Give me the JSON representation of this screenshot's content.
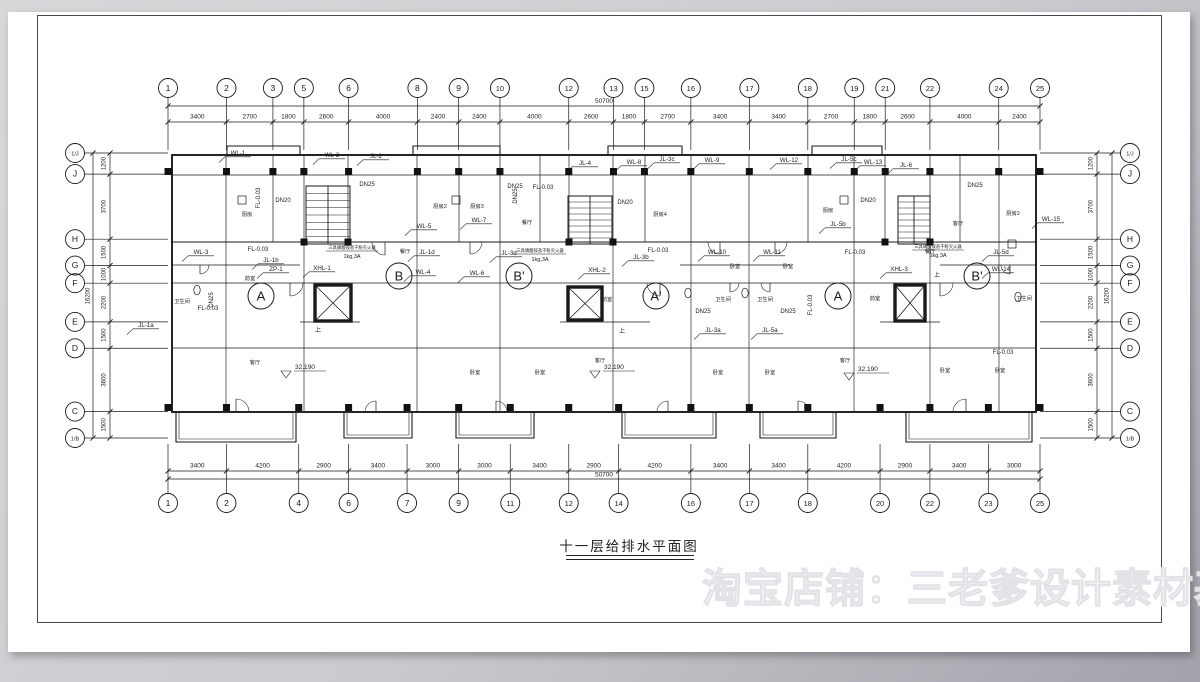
{
  "page": {
    "title": "十一层给排水平面图",
    "watermark": "淘宝店铺：三老爹设计素材基地"
  },
  "axes": {
    "top": {
      "bubbles": [
        "1",
        "2",
        "3",
        "5",
        "6",
        "8",
        "9",
        "10",
        "12",
        "13",
        "15",
        "16",
        "17",
        "18",
        "19",
        "21",
        "22",
        "24",
        "25"
      ],
      "dims": [
        3400,
        2700,
        1800,
        2600,
        4000,
        2400,
        2400,
        4000,
        2600,
        1800,
        2700,
        3400,
        3400,
        2700,
        1800,
        2600,
        4000,
        2400
      ],
      "total": "50700"
    },
    "bottom": {
      "bubbles": [
        "1",
        "2",
        "4",
        "6",
        "7",
        "9",
        "11",
        "12",
        "14",
        "16",
        "17",
        "18",
        "20",
        "22",
        "23",
        "25"
      ],
      "dims": [
        3400,
        4200,
        2900,
        3400,
        3000,
        3000,
        3400,
        2900,
        4200,
        3400,
        3400,
        4200,
        2900,
        3400,
        3000
      ],
      "total": "50700"
    },
    "left": {
      "bubbles": [
        "1/J",
        "J",
        "H",
        "G",
        "F",
        "E",
        "D",
        "C",
        "1/B"
      ],
      "dims": [
        1200,
        3700,
        1500,
        1000,
        2200,
        1500,
        3600,
        1500
      ],
      "total": "16200"
    },
    "right": {
      "bubbles": [
        "1/J",
        "J",
        "H",
        "G",
        "F",
        "E",
        "D",
        "C",
        "1/B"
      ],
      "dims": [
        1200,
        3700,
        1500,
        1000,
        2200,
        1500,
        3600,
        1500
      ],
      "total": "16200"
    }
  },
  "plan": {
    "unit_circles": [
      "A",
      "B",
      "B'",
      "A'",
      "A",
      "B'"
    ],
    "riser_labels": [
      "WL-1",
      "WL-2",
      "JL-2",
      "WL-3",
      "JL-1a",
      "JL-1b",
      "ZP-1",
      "XHL-1",
      "WL-5",
      "WL-7",
      "JL-1d",
      "JL-3d",
      "WL-4",
      "WL-6",
      "JL-4",
      "WL-8",
      "JL-3c",
      "WL-9",
      "JL-3b",
      "XHL-2",
      "WL-10",
      "WL-11",
      "JL-3a",
      "JL-5a",
      "JL-5b",
      "WL-12",
      "JL-5c",
      "WL-13",
      "JL-6",
      "XHL-3",
      "WL-14",
      "JL-5d",
      "WL-15"
    ],
    "pipe_labels": [
      "DN25",
      "DN25",
      "DN25",
      "DN25",
      "DN25",
      "DN25",
      "DN25",
      "DN20",
      "DN20",
      "DN20",
      "FL-0.03",
      "FL-0.03",
      "FL-0.03",
      "FL-0.03",
      "FL-0.03",
      "FL-0.03",
      "FL-0.03",
      "FL-0.03"
    ],
    "elevation": "32.190",
    "fire_note_line1": "三具磷酸铵盐干粉灭火器",
    "fire_note_line2": "1kg,3A",
    "stair_up": "上",
    "rooms": [
      "厨房",
      "厨房2",
      "厨房3",
      "厨房4",
      "厨房",
      "厨房2",
      "卫生间",
      "卫生间",
      "卫生间",
      "卫生间",
      "前室",
      "前室",
      "前室",
      "客厅",
      "客厅",
      "客厅",
      "客厅",
      "餐厅",
      "餐厅",
      "餐厅",
      "卧室",
      "卧室",
      "卧室",
      "卧室",
      "卧室",
      "卧室",
      "卧室",
      "卧室"
    ]
  },
  "colors": {
    "line": "#1a1a1a",
    "sheet": "#ffffff",
    "backdrop": "#c7c7cc"
  }
}
